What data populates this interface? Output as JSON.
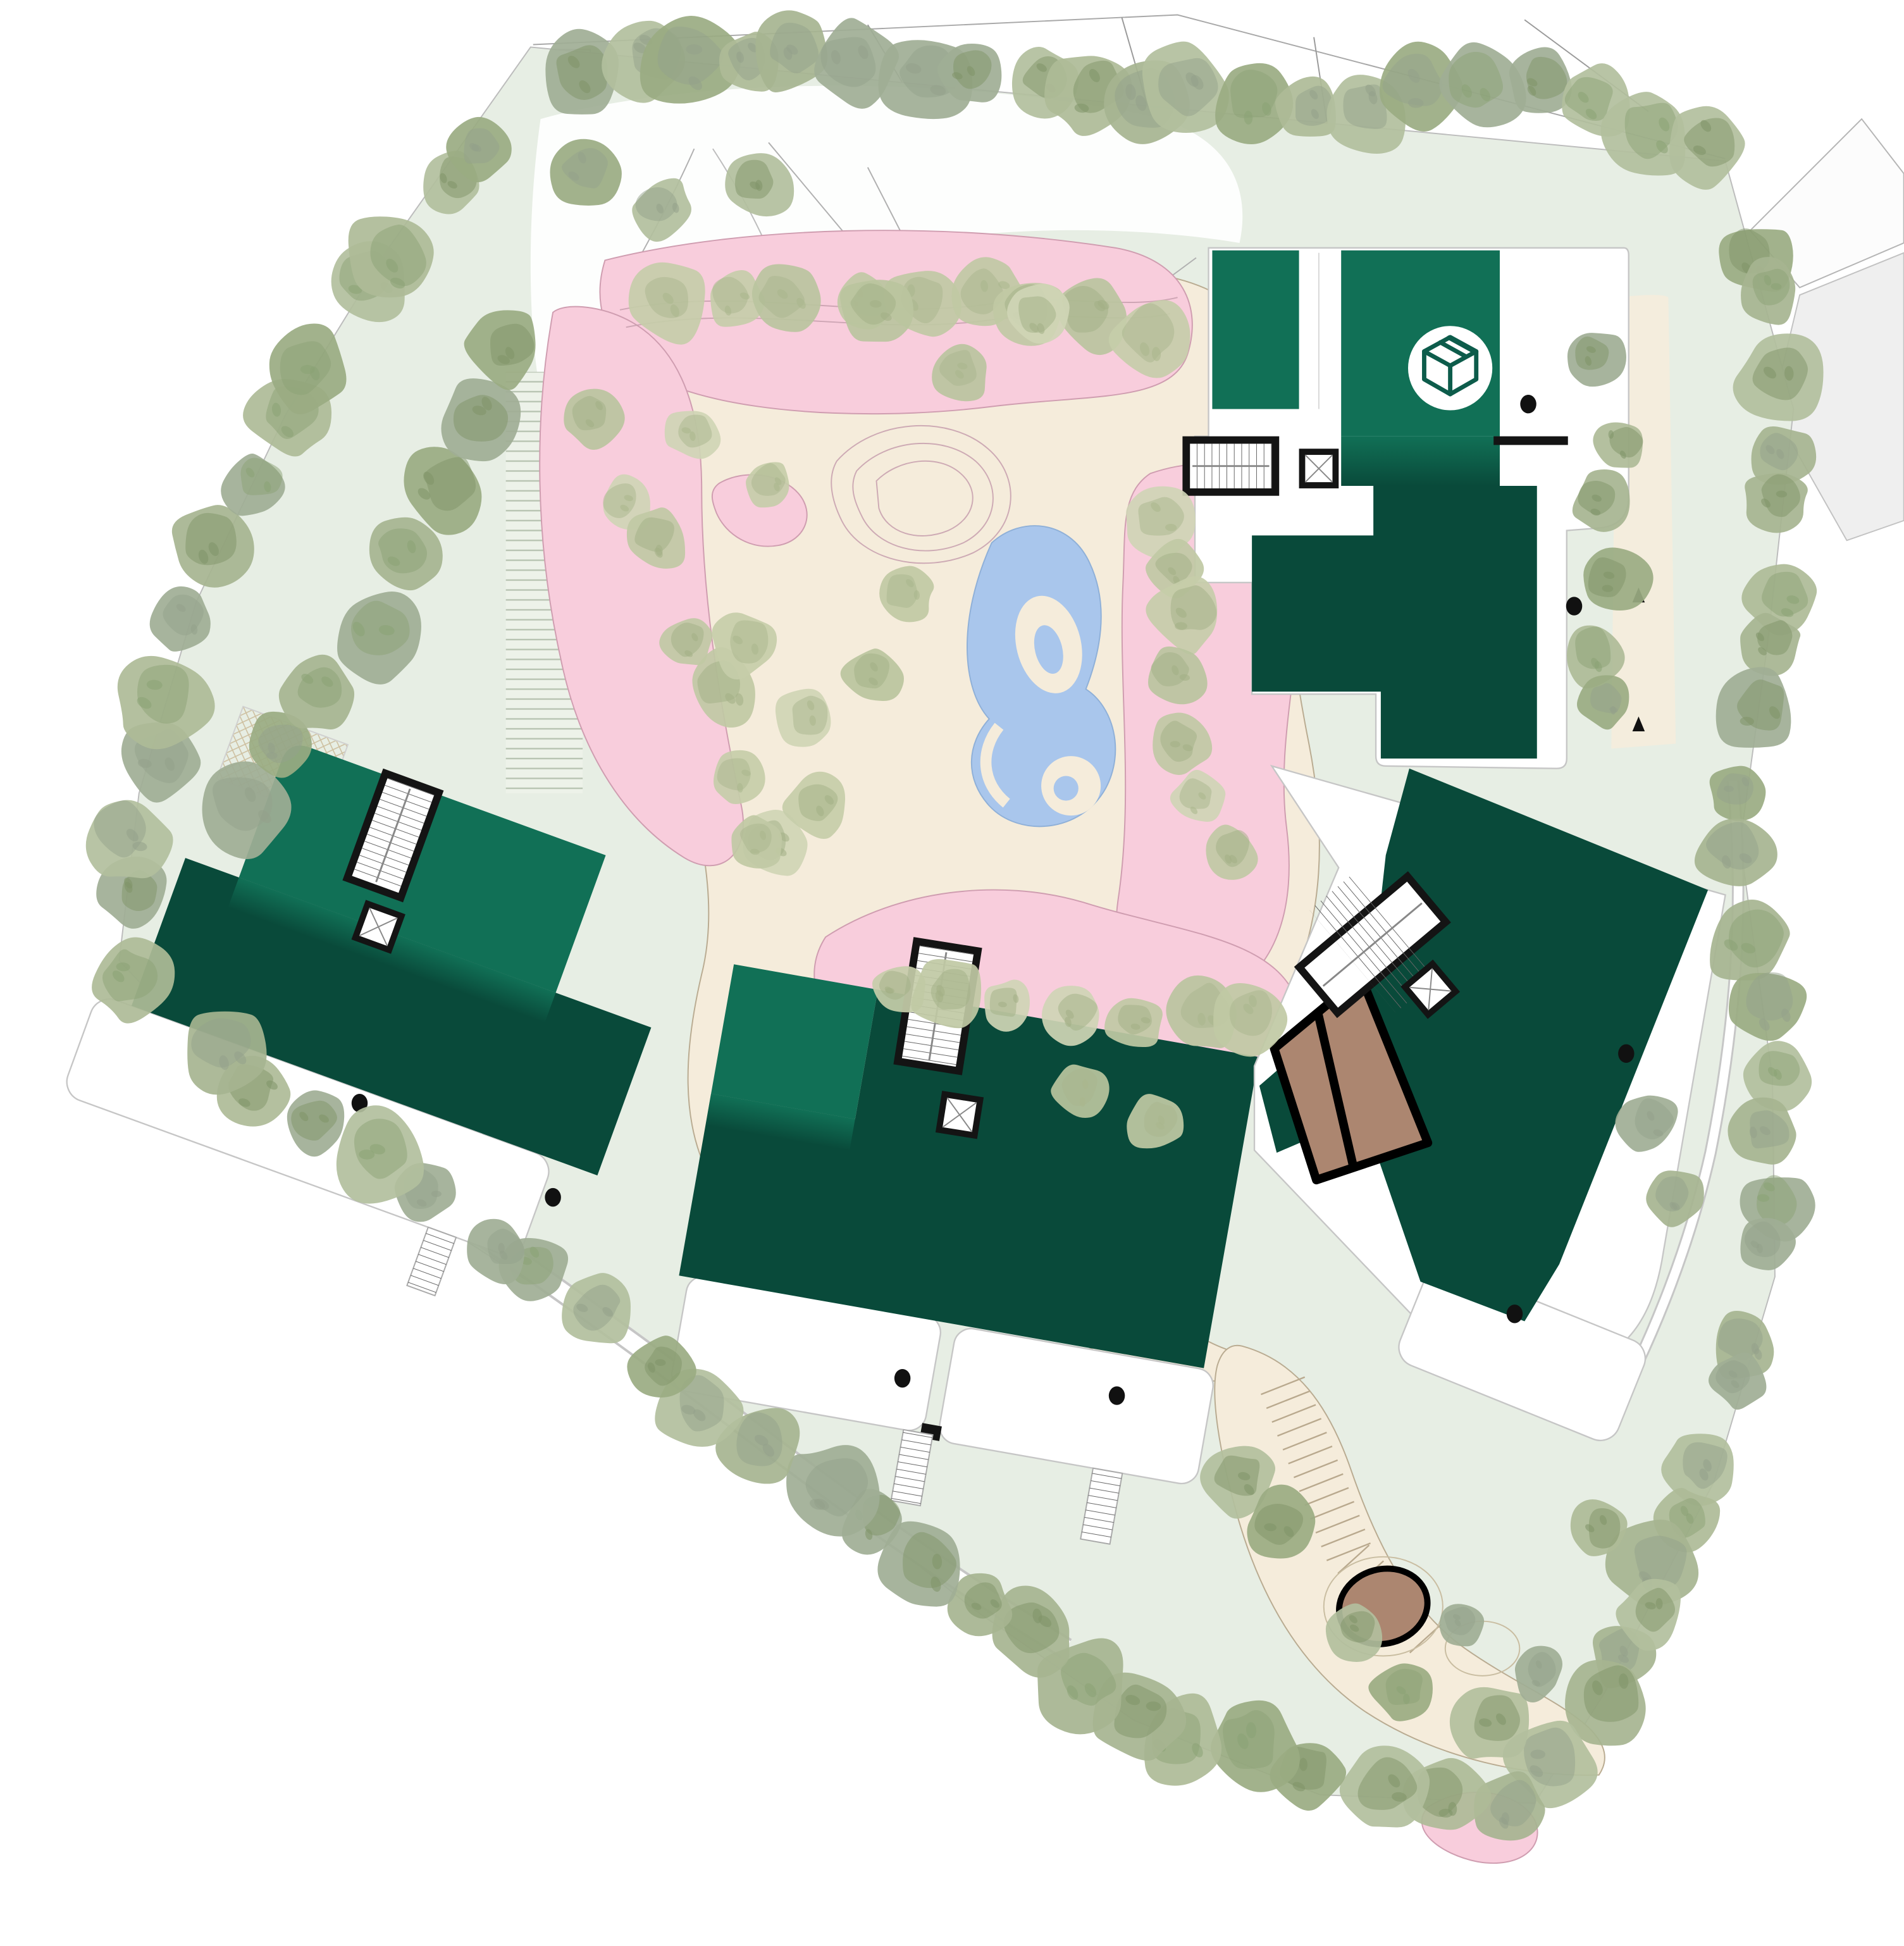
{
  "drawing": {
    "kind": "architectural-site-plan",
    "view": "roof-plan-with-landscape"
  },
  "palette": {
    "paper": "#ffffff",
    "lawn": "#e7eee4",
    "lawn_bright": "#dfe9dc",
    "plaza": "#f5ecdb",
    "plaza_edge": "#b9ab91",
    "pink": "#f8cddc",
    "pink_edge": "#cf9db0",
    "pond": "#a9c6ec",
    "pond_edge": "#8fb0d8",
    "roof_light": "#117056",
    "roof_dark": "#094a3a",
    "core": "#141414",
    "line": "#9a9a9a",
    "line_soft": "#c6c6c6",
    "brown": "#ac8670",
    "hatch": "#cdbf9f",
    "stripe": "#b7c3b1",
    "icon_stroke": "#0d5c4b",
    "road_gray": "#efefef",
    "tread": "#666666"
  },
  "icon_marker": {
    "name": "package-icon",
    "glyph": "isometric-cube"
  },
  "roof_drains": [
    [
      1233,
      326
    ],
    [
      1270,
      489
    ],
    [
      290,
      890
    ],
    [
      446,
      966
    ],
    [
      728,
      1112
    ],
    [
      901,
      1126
    ],
    [
      1312,
      850
    ],
    [
      1222,
      1060
    ]
  ],
  "step_paths": [
    {
      "from": [
        1035,
        1118
      ],
      "to": [
        1088,
        1252
      ],
      "count": 12,
      "half": 19
    },
    {
      "from": [
        1092,
        1258
      ],
      "to": [
        1150,
        1322
      ],
      "count": 5,
      "half": 17
    }
  ],
  "trees": {
    "palettes": {
      "peri": {
        "body": [
          "#a6b490",
          "#9aab82",
          "#b2bf9d",
          "#9fae95",
          "#aebb97"
        ],
        "accent": [
          "#7f9468",
          "#8ba275",
          "#93a18b"
        ]
      },
      "fluffy": {
        "body": [
          "#c6cda9",
          "#bac49e",
          "#cfd5b5",
          "#c0c9a4"
        ],
        "accent": [
          "#a2af85",
          "#aab68d"
        ]
      }
    },
    "bands": [
      {
        "pts": [
          [
            445,
            62
          ],
          [
            640,
            44
          ],
          [
            840,
            70
          ],
          [
            1040,
            88
          ],
          [
            1230,
            70
          ],
          [
            1390,
            125
          ]
        ],
        "n": 21,
        "r": [
          26,
          44
        ],
        "pal": "peri"
      },
      {
        "pts": [
          [
            1402,
            175
          ],
          [
            1446,
            335
          ],
          [
            1424,
            520
          ],
          [
            1404,
            682
          ],
          [
            1428,
            866
          ],
          [
            1430,
            1024
          ],
          [
            1382,
            1192
          ],
          [
            1298,
            1360
          ],
          [
            1243,
            1450
          ]
        ],
        "n": 24,
        "r": [
          24,
          40
        ],
        "pal": "peri"
      },
      {
        "pts": [
          [
            1238,
            1452
          ],
          [
            1080,
            1444
          ],
          [
            930,
            1390
          ],
          [
            800,
            1300
          ],
          [
            644,
            1182
          ]
        ],
        "n": 13,
        "r": [
          26,
          42
        ],
        "pal": "peri"
      },
      {
        "pts": [
          [
            640,
            1180
          ],
          [
            478,
            1064
          ],
          [
            330,
            958
          ],
          [
            182,
            848
          ],
          [
            100,
            780
          ]
        ],
        "n": 12,
        "r": [
          26,
          40
        ],
        "pal": "peri"
      },
      {
        "pts": [
          [
            96,
            758
          ],
          [
            114,
            636
          ],
          [
            160,
            486
          ],
          [
            230,
            336
          ],
          [
            314,
            202
          ],
          [
            420,
            88
          ]
        ],
        "n": 13,
        "r": [
          26,
          42
        ],
        "pal": "peri"
      },
      {
        "pts": [
          [
            170,
            690
          ],
          [
            230,
            600
          ],
          [
            290,
            520
          ],
          [
            330,
            440
          ],
          [
            380,
            350
          ],
          [
            432,
            252
          ]
        ],
        "n": 8,
        "r": [
          28,
          42
        ],
        "pal": "peri"
      },
      {
        "pts": [
          [
            1288,
            258
          ],
          [
            1302,
            352
          ],
          [
            1300,
            452
          ],
          [
            1290,
            548
          ],
          [
            1300,
            612
          ]
        ],
        "n": 6,
        "r": [
          20,
          30
        ],
        "pal": "peri"
      },
      {
        "pts": [
          [
            986,
            1168
          ],
          [
            1046,
            1244
          ],
          [
            1124,
            1352
          ],
          [
            1212,
            1404
          ]
        ],
        "n": 5,
        "r": [
          22,
          34
        ],
        "pal": "peri"
      },
      {
        "pts": [
          [
            520,
            250
          ],
          [
            640,
            248
          ],
          [
            760,
            244
          ],
          [
            880,
            252
          ],
          [
            952,
            282
          ]
        ],
        "n": 9,
        "r": [
          24,
          36
        ],
        "pal": "fluffy"
      },
      {
        "pts": [
          [
            470,
            320
          ],
          [
            520,
            420
          ],
          [
            560,
            520
          ],
          [
            600,
            620
          ],
          [
            640,
            700
          ]
        ],
        "n": 7,
        "r": [
          22,
          32
        ],
        "pal": "fluffy"
      },
      {
        "pts": [
          [
            920,
            390
          ],
          [
            960,
            470
          ],
          [
            950,
            560
          ],
          [
            960,
            650
          ],
          [
            1000,
            700
          ]
        ],
        "n": 7,
        "r": [
          22,
          32
        ],
        "pal": "fluffy"
      },
      {
        "pts": [
          [
            690,
            780
          ],
          [
            780,
            810
          ],
          [
            880,
            820
          ],
          [
            980,
            810
          ],
          [
            1040,
            840
          ]
        ],
        "n": 7,
        "r": [
          22,
          32
        ],
        "pal": "fluffy"
      }
    ],
    "scatter": [
      [
        470,
        140,
        30,
        "peri"
      ],
      [
        535,
        168,
        26,
        "peri"
      ],
      [
        612,
        150,
        28,
        "peri"
      ],
      [
        600,
        520,
        28,
        "fluffy"
      ],
      [
        650,
        580,
        26,
        "fluffy"
      ],
      [
        705,
        545,
        26,
        "fluffy"
      ],
      [
        660,
        650,
        28,
        "fluffy"
      ],
      [
        610,
        680,
        24,
        "fluffy"
      ],
      [
        730,
        480,
        24,
        "fluffy"
      ],
      [
        560,
        350,
        24,
        "fluffy"
      ],
      [
        620,
        390,
        22,
        "fluffy"
      ],
      [
        870,
        880,
        24,
        "fluffy"
      ],
      [
        930,
        905,
        24,
        "fluffy"
      ],
      [
        1330,
        905,
        26,
        "peri"
      ],
      [
        1352,
        966,
        24,
        "peri"
      ],
      [
        705,
        250,
        30,
        "fluffy"
      ],
      [
        775,
        300,
        26,
        "fluffy"
      ],
      [
        840,
        255,
        28,
        "fluffy"
      ],
      [
        1290,
        1235,
        26,
        "peri"
      ],
      [
        1332,
        1302,
        28,
        "peri"
      ],
      [
        1180,
        1310,
        20,
        "peri"
      ],
      [
        1240,
        1350,
        22,
        "peri"
      ]
    ]
  }
}
